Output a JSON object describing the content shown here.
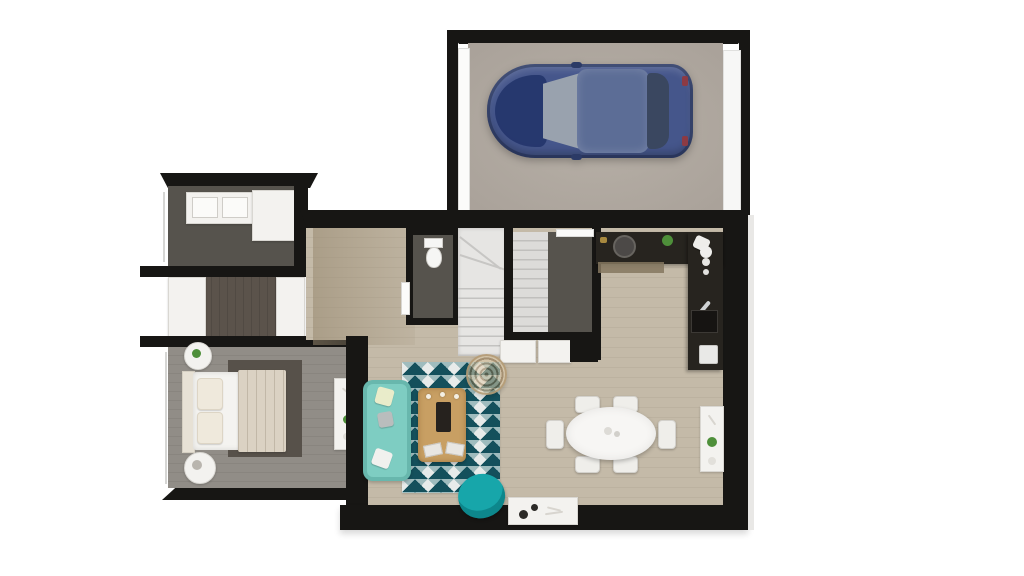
{
  "meta": {
    "title": "3D top-down floor plan render, ground floor with attached garage",
    "canvas_width": 1024,
    "canvas_height": 576,
    "visible_text": "none"
  },
  "colors": {
    "wall": "#171614",
    "garage-floor": "#b7b0a7",
    "car-body": "#45568b",
    "car-hood": "#24356b",
    "car-roof": "#5c6d96",
    "dark-floor": "#56534d",
    "dress-floor": "#5b534b",
    "hall-floor": "#5e564e",
    "bedroom-floor": "#918d87",
    "bed-rug": "#57514a",
    "blanket": "#dbd2c3",
    "living-floor": "#c4baa8",
    "stairs": "#e6e5e3",
    "counter": "#27241f",
    "furn-white": "#f3f2ef",
    "sofa": "#7ecdc2",
    "armchair": "#17a6aa",
    "rug-dark": "#14505c",
    "rug-mid": "#9fbcbe",
    "coffee-table": "#c89f63",
    "table": "#f7f6f4",
    "plant": "#4e8f3a"
  },
  "rooms": [
    {
      "id": "garage",
      "contents": [
        "blue-car",
        "garage-door-left",
        "garage-door-right"
      ]
    },
    {
      "id": "bathroom",
      "contents": [
        "double-sink-vanity",
        "walk-in-shower"
      ]
    },
    {
      "id": "dressing-corridor",
      "contents": [
        "closet-left",
        "closet-right"
      ]
    },
    {
      "id": "bedroom",
      "contents": [
        "double-bed",
        "area-rug",
        "nightstand-top",
        "nightstand-bottom",
        "dresser"
      ]
    },
    {
      "id": "wc",
      "contents": [
        "toilet",
        "door"
      ]
    },
    {
      "id": "staircase",
      "contents": [
        "winder-steps",
        "straight-treads"
      ]
    },
    {
      "id": "utility-room",
      "contents": [
        "dark-floor",
        "white-cabinets"
      ]
    },
    {
      "id": "kitchen",
      "contents": [
        "l-shaped-dark-counter",
        "hob",
        "sink",
        "plant",
        "mixer",
        "dishes",
        "appliance"
      ]
    },
    {
      "id": "living-dining",
      "contents": [
        "teal-sofa",
        "geometric-rug",
        "wood-coffee-table",
        "rattan-pendant",
        "teal-armchair",
        "tv-console",
        "oval-dining-table",
        "six-chairs",
        "sideboard"
      ]
    }
  ]
}
